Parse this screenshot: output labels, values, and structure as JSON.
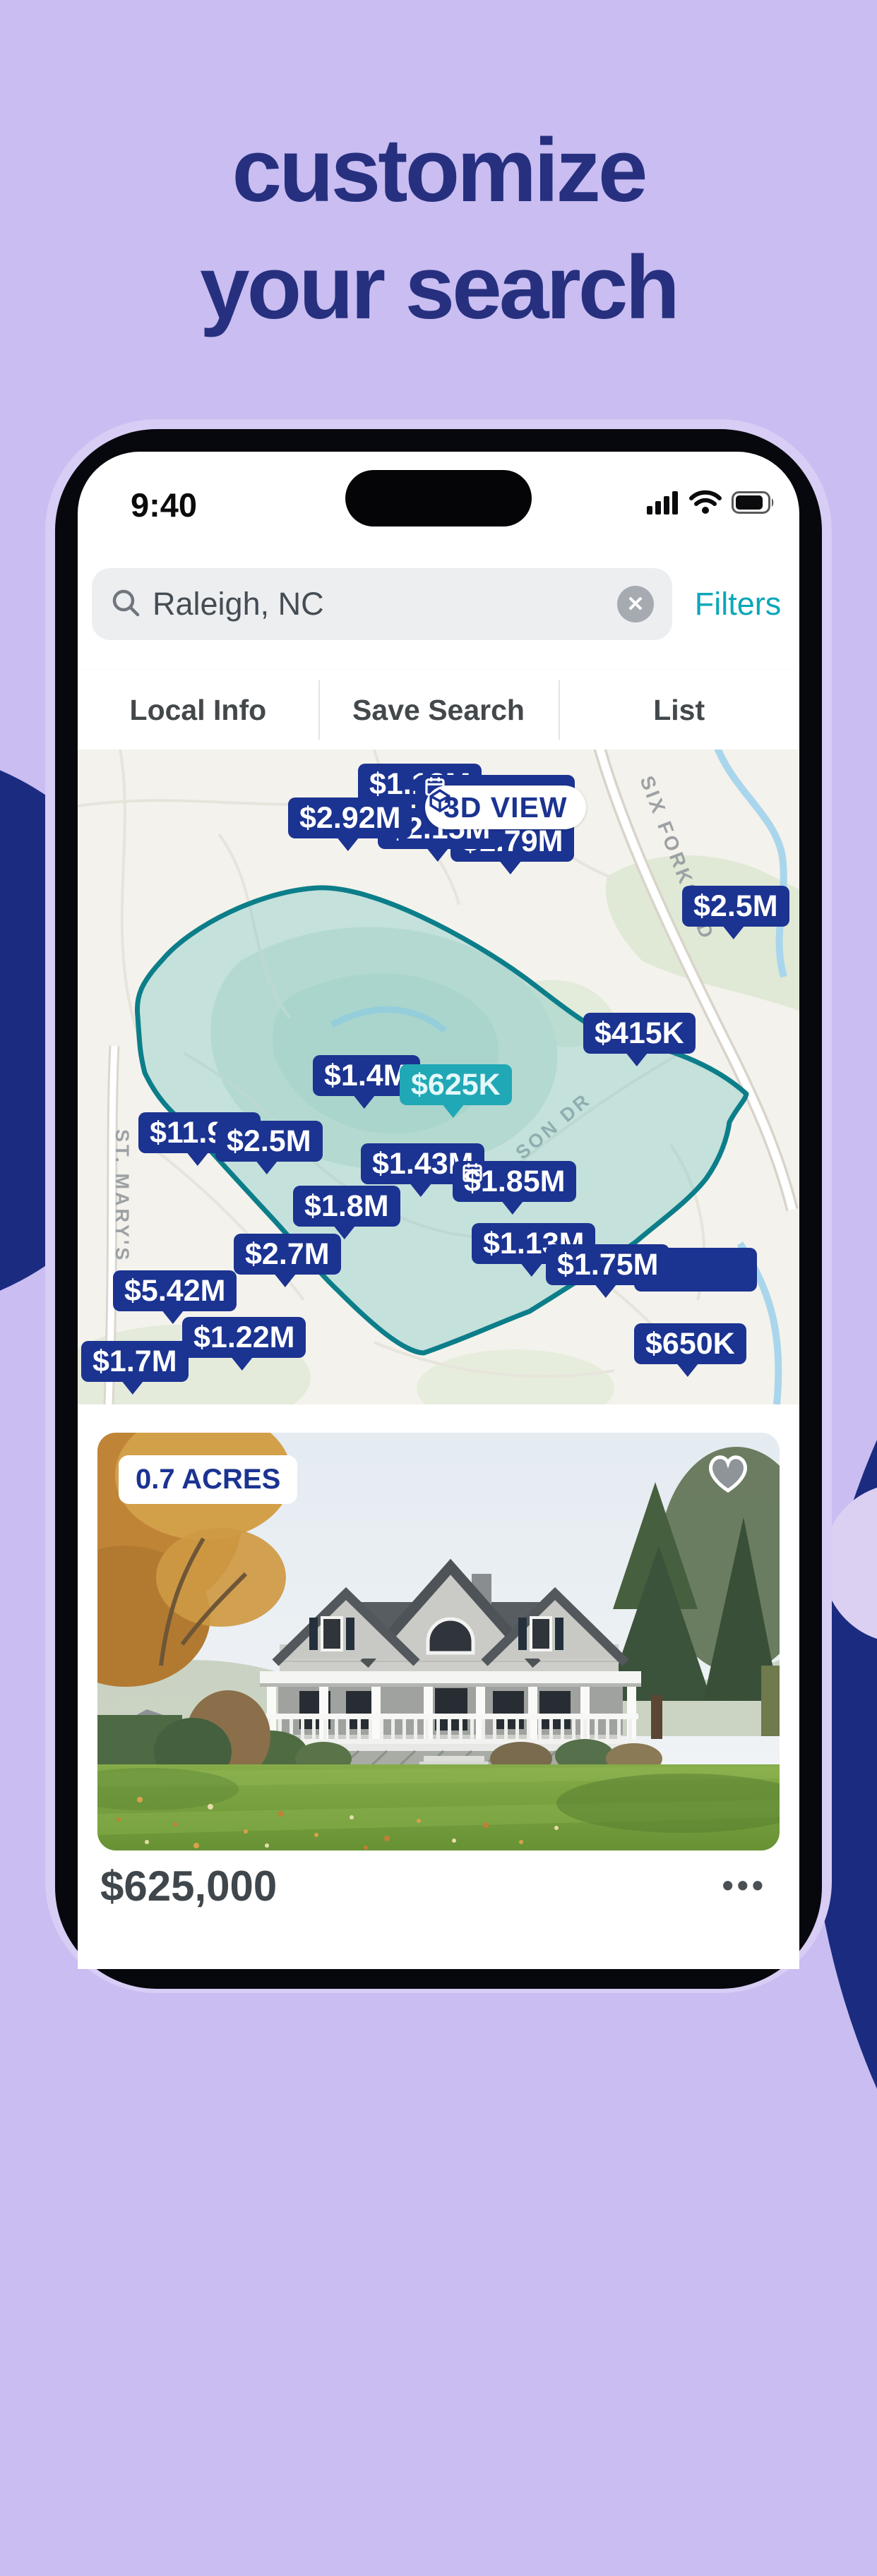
{
  "hero": {
    "title_line1": "customize",
    "title_line2": "your search"
  },
  "status_bar": {
    "time": "9:40"
  },
  "search_bar": {
    "value": "Raleigh, NC",
    "clear_symbol": "✕",
    "filters_label": "Filters"
  },
  "tabs": [
    "Local Info",
    "Save Search",
    "List"
  ],
  "map": {
    "view_3d_label": "3D VIEW",
    "road_labels": {
      "six_forks": "SIX FORKS RD",
      "st_marys": "ST. MARY'S ST",
      "son_dr": "SON DR"
    },
    "pins": [
      {
        "label": "$1.18M",
        "covered": false,
        "calendar": false
      },
      {
        "label": "",
        "covered": true,
        "calendar": true
      },
      {
        "label": "$1.79M",
        "covered": false,
        "calendar": false
      },
      {
        "label": "$2.15M",
        "covered": false,
        "calendar": false
      },
      {
        "label": "$2.92M",
        "covered": false,
        "calendar": false
      },
      {
        "label": "$2.5M",
        "covered": false,
        "calendar": false
      },
      {
        "label": "$415K",
        "covered": false,
        "calendar": false
      },
      {
        "label": "$1.4M",
        "covered": false,
        "calendar": false
      },
      {
        "label": "$625K",
        "covered": false,
        "calendar": false,
        "highlight": true
      },
      {
        "label": "$11.9M",
        "covered": false,
        "calendar": false
      },
      {
        "label": "$2.5M",
        "covered": false,
        "calendar": false
      },
      {
        "label": "$1.43M",
        "covered": false,
        "calendar": false
      },
      {
        "label": "$1.85M",
        "covered": false,
        "calendar": true
      },
      {
        "label": "$1.8M",
        "covered": false,
        "calendar": false
      },
      {
        "label": "$1.13M",
        "covered": false,
        "calendar": false
      },
      {
        "label": "",
        "covered": true,
        "calendar": false
      },
      {
        "label": "$1.75M",
        "covered": false,
        "calendar": false
      },
      {
        "label": "$2.7M",
        "covered": false,
        "calendar": false
      },
      {
        "label": "$5.42M",
        "covered": false,
        "calendar": false
      },
      {
        "label": "$1.22M",
        "covered": false,
        "calendar": false
      },
      {
        "label": "$1.7M",
        "covered": false,
        "calendar": false
      },
      {
        "label": "$650K",
        "covered": false,
        "calendar": false
      }
    ]
  },
  "listing_card": {
    "badge": "0.7 ACRES",
    "price": "$625,000",
    "more_label": "•••"
  },
  "colors": {
    "background": "#C9BDF1",
    "title": "#27307F",
    "deco_navy": "#1B2B80",
    "pin_navy": "#1B3391",
    "pin_teal": "#21A8B6",
    "accent_teal": "#0BA7B8",
    "search_area_stroke": "#0C7E8A"
  }
}
